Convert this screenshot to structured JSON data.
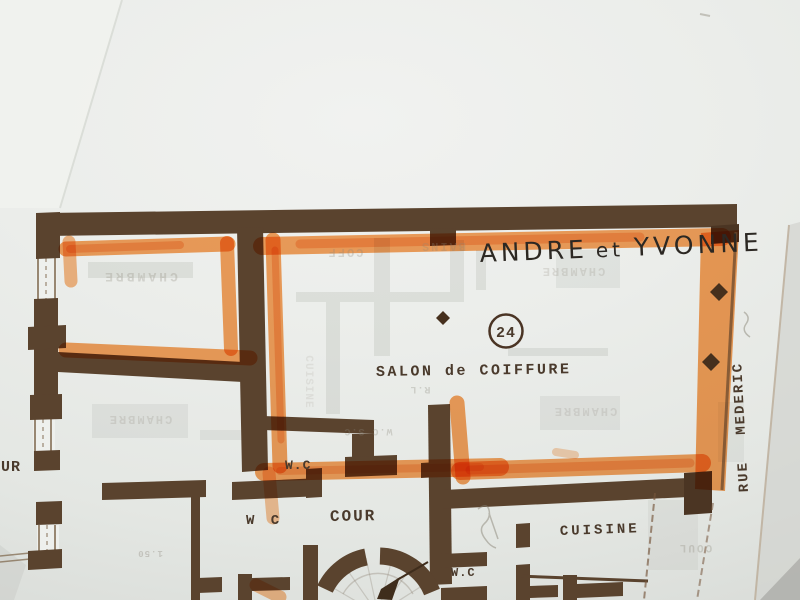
{
  "title": {
    "word1": "ANDRE",
    "word2": "et",
    "word3": "YVONNE"
  },
  "unit_badge": "24",
  "labels": {
    "salon": "SALON de COIFFURE",
    "wc_upper": "W.C",
    "wc_left": "W C",
    "wc_lower": "W.C",
    "cour": "COUR",
    "cuisine": "CUISINE",
    "cour_cut": "UR",
    "street": "RUE MEDERIC"
  },
  "ghost_labels": [
    "CHAMBRE",
    "COFF",
    "BAINS",
    "CHAMBRE",
    "CHAMBRE",
    "CHAMBRE",
    "W.C  S.C",
    "R.L",
    "COUL",
    "1.50",
    "CUISINE"
  ],
  "colors": {
    "highlighter": "#f78c35",
    "wall": "#5a432e",
    "paper": "#e9ebe7",
    "ink": "#4a3a2c",
    "handwriting": "#2c2823"
  }
}
